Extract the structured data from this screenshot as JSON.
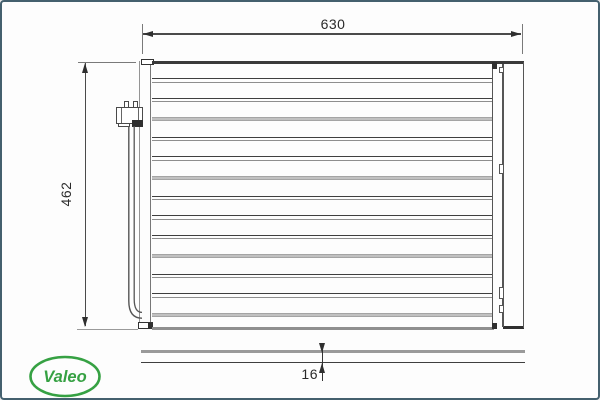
{
  "dimensions": {
    "width": "630",
    "height": "462",
    "depth": "16"
  },
  "logo": {
    "brand": "Valeo",
    "color": "#36a143"
  },
  "part": {
    "description": "condenser-front-view",
    "core_rows": [
      {
        "y": 76.0,
        "style": "pair"
      },
      {
        "y": 95.6,
        "style": "pair"
      },
      {
        "y": 115.2,
        "style": "band"
      },
      {
        "y": 134.7,
        "style": "pair"
      },
      {
        "y": 154.3,
        "style": "pair"
      },
      {
        "y": 173.9,
        "style": "band"
      },
      {
        "y": 193.5,
        "style": "pair"
      },
      {
        "y": 213.1,
        "style": "pair"
      },
      {
        "y": 232.6,
        "style": "pair"
      },
      {
        "y": 252.2,
        "style": "band"
      },
      {
        "y": 271.8,
        "style": "pair"
      },
      {
        "y": 291.4,
        "style": "pair"
      },
      {
        "y": 310.9,
        "style": "band"
      }
    ],
    "right_tank_notches": [
      {
        "y": 64.5,
        "h": 6
      },
      {
        "y": 161.5,
        "h": 10
      },
      {
        "y": 284.5,
        "h": 12
      },
      {
        "y": 302.5,
        "h": 8
      }
    ]
  },
  "colors": {
    "frame_border": "#44606e",
    "line_dark": "#3d3d3d",
    "line_gray": "#9a9a9a"
  }
}
